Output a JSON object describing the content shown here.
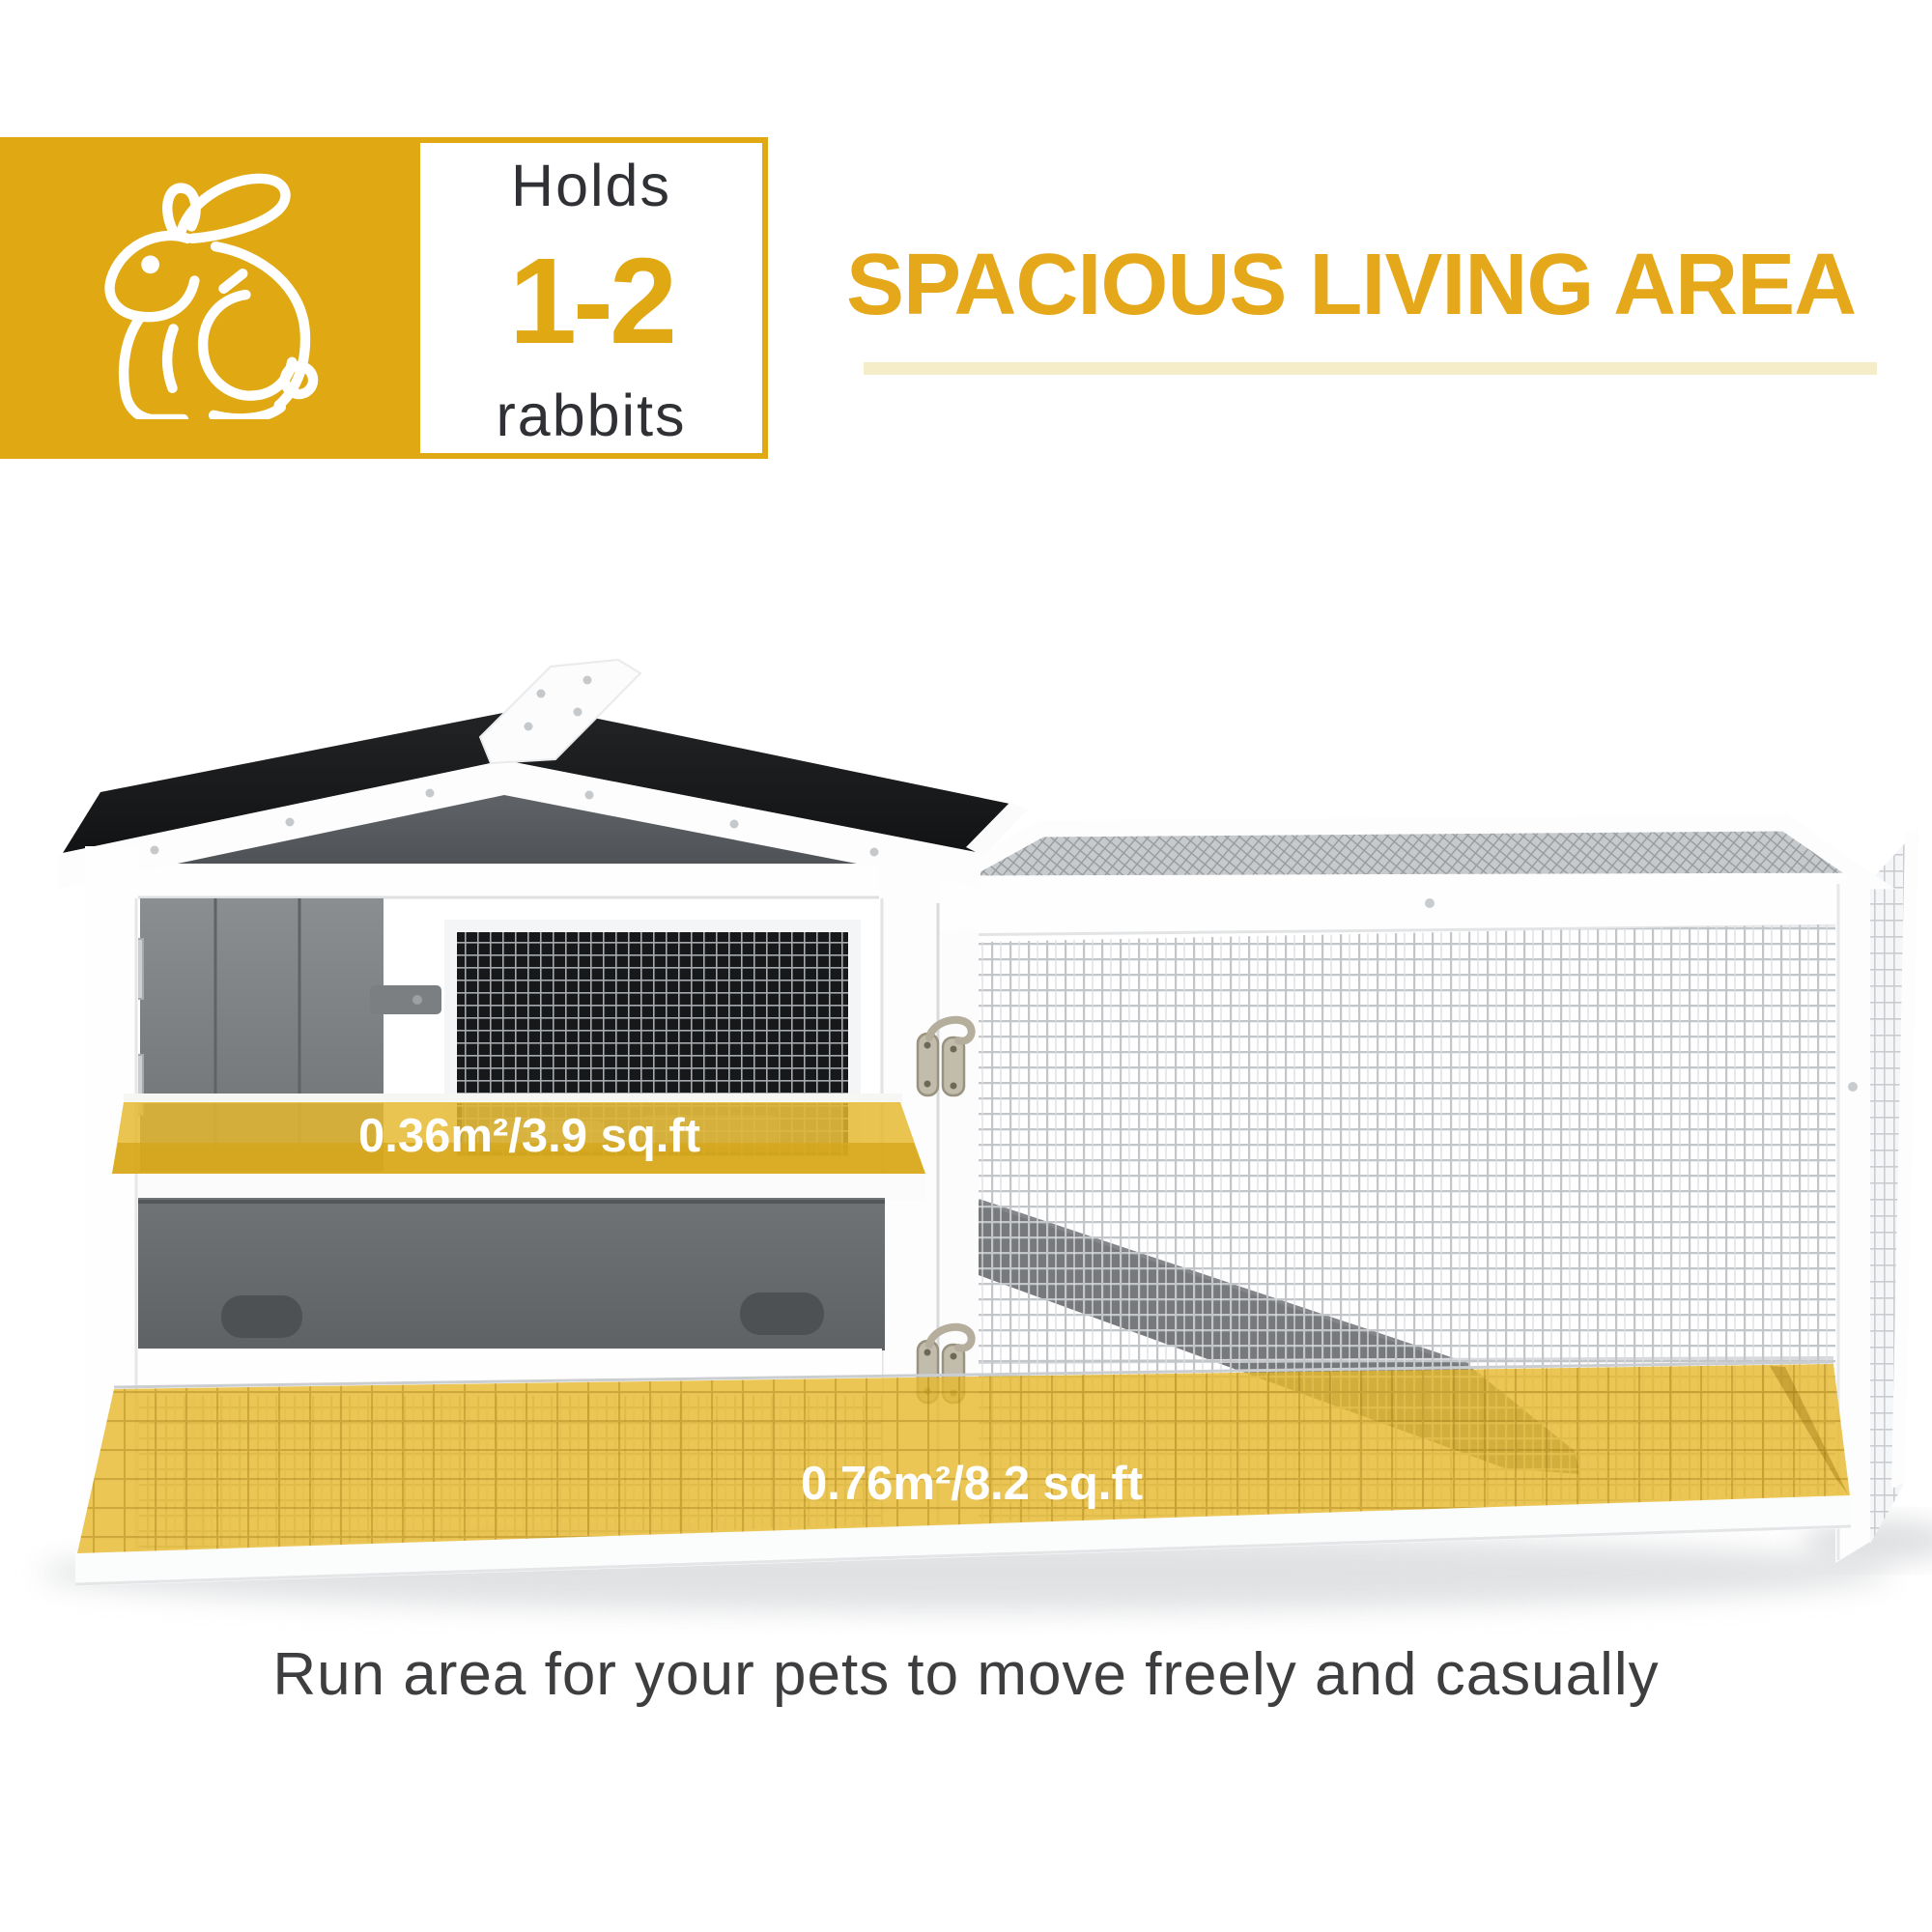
{
  "badge": {
    "icon": "rabbit-icon",
    "holds_label": "Holds",
    "capacity": "1-2",
    "capacity_unit": "rabbits",
    "background_color": "#E0A813"
  },
  "heading": {
    "title": "SPACIOUS LIVING AREA",
    "accent_color": "#E4A81A",
    "underline_color": "#F5ECC8"
  },
  "product_photo": {
    "subject": "two-story rabbit hutch with attached wire run",
    "hutch_floor_label": "0.36m²/3.9 sq.ft",
    "run_floor_label": "0.76m²/8.2 sq.ft",
    "highlight_color": "#E6B92F"
  },
  "caption": {
    "text": "Run area for your pets to move freely and casually"
  },
  "colors": {
    "brand_gold": "#E0A813",
    "pale_underline": "#F5ECC8",
    "overlay_yellow": "#E6B92F",
    "roof_black": "#1B1C1E",
    "wood_gray": "#8B8E91",
    "dark_text": "#3E3E40"
  }
}
